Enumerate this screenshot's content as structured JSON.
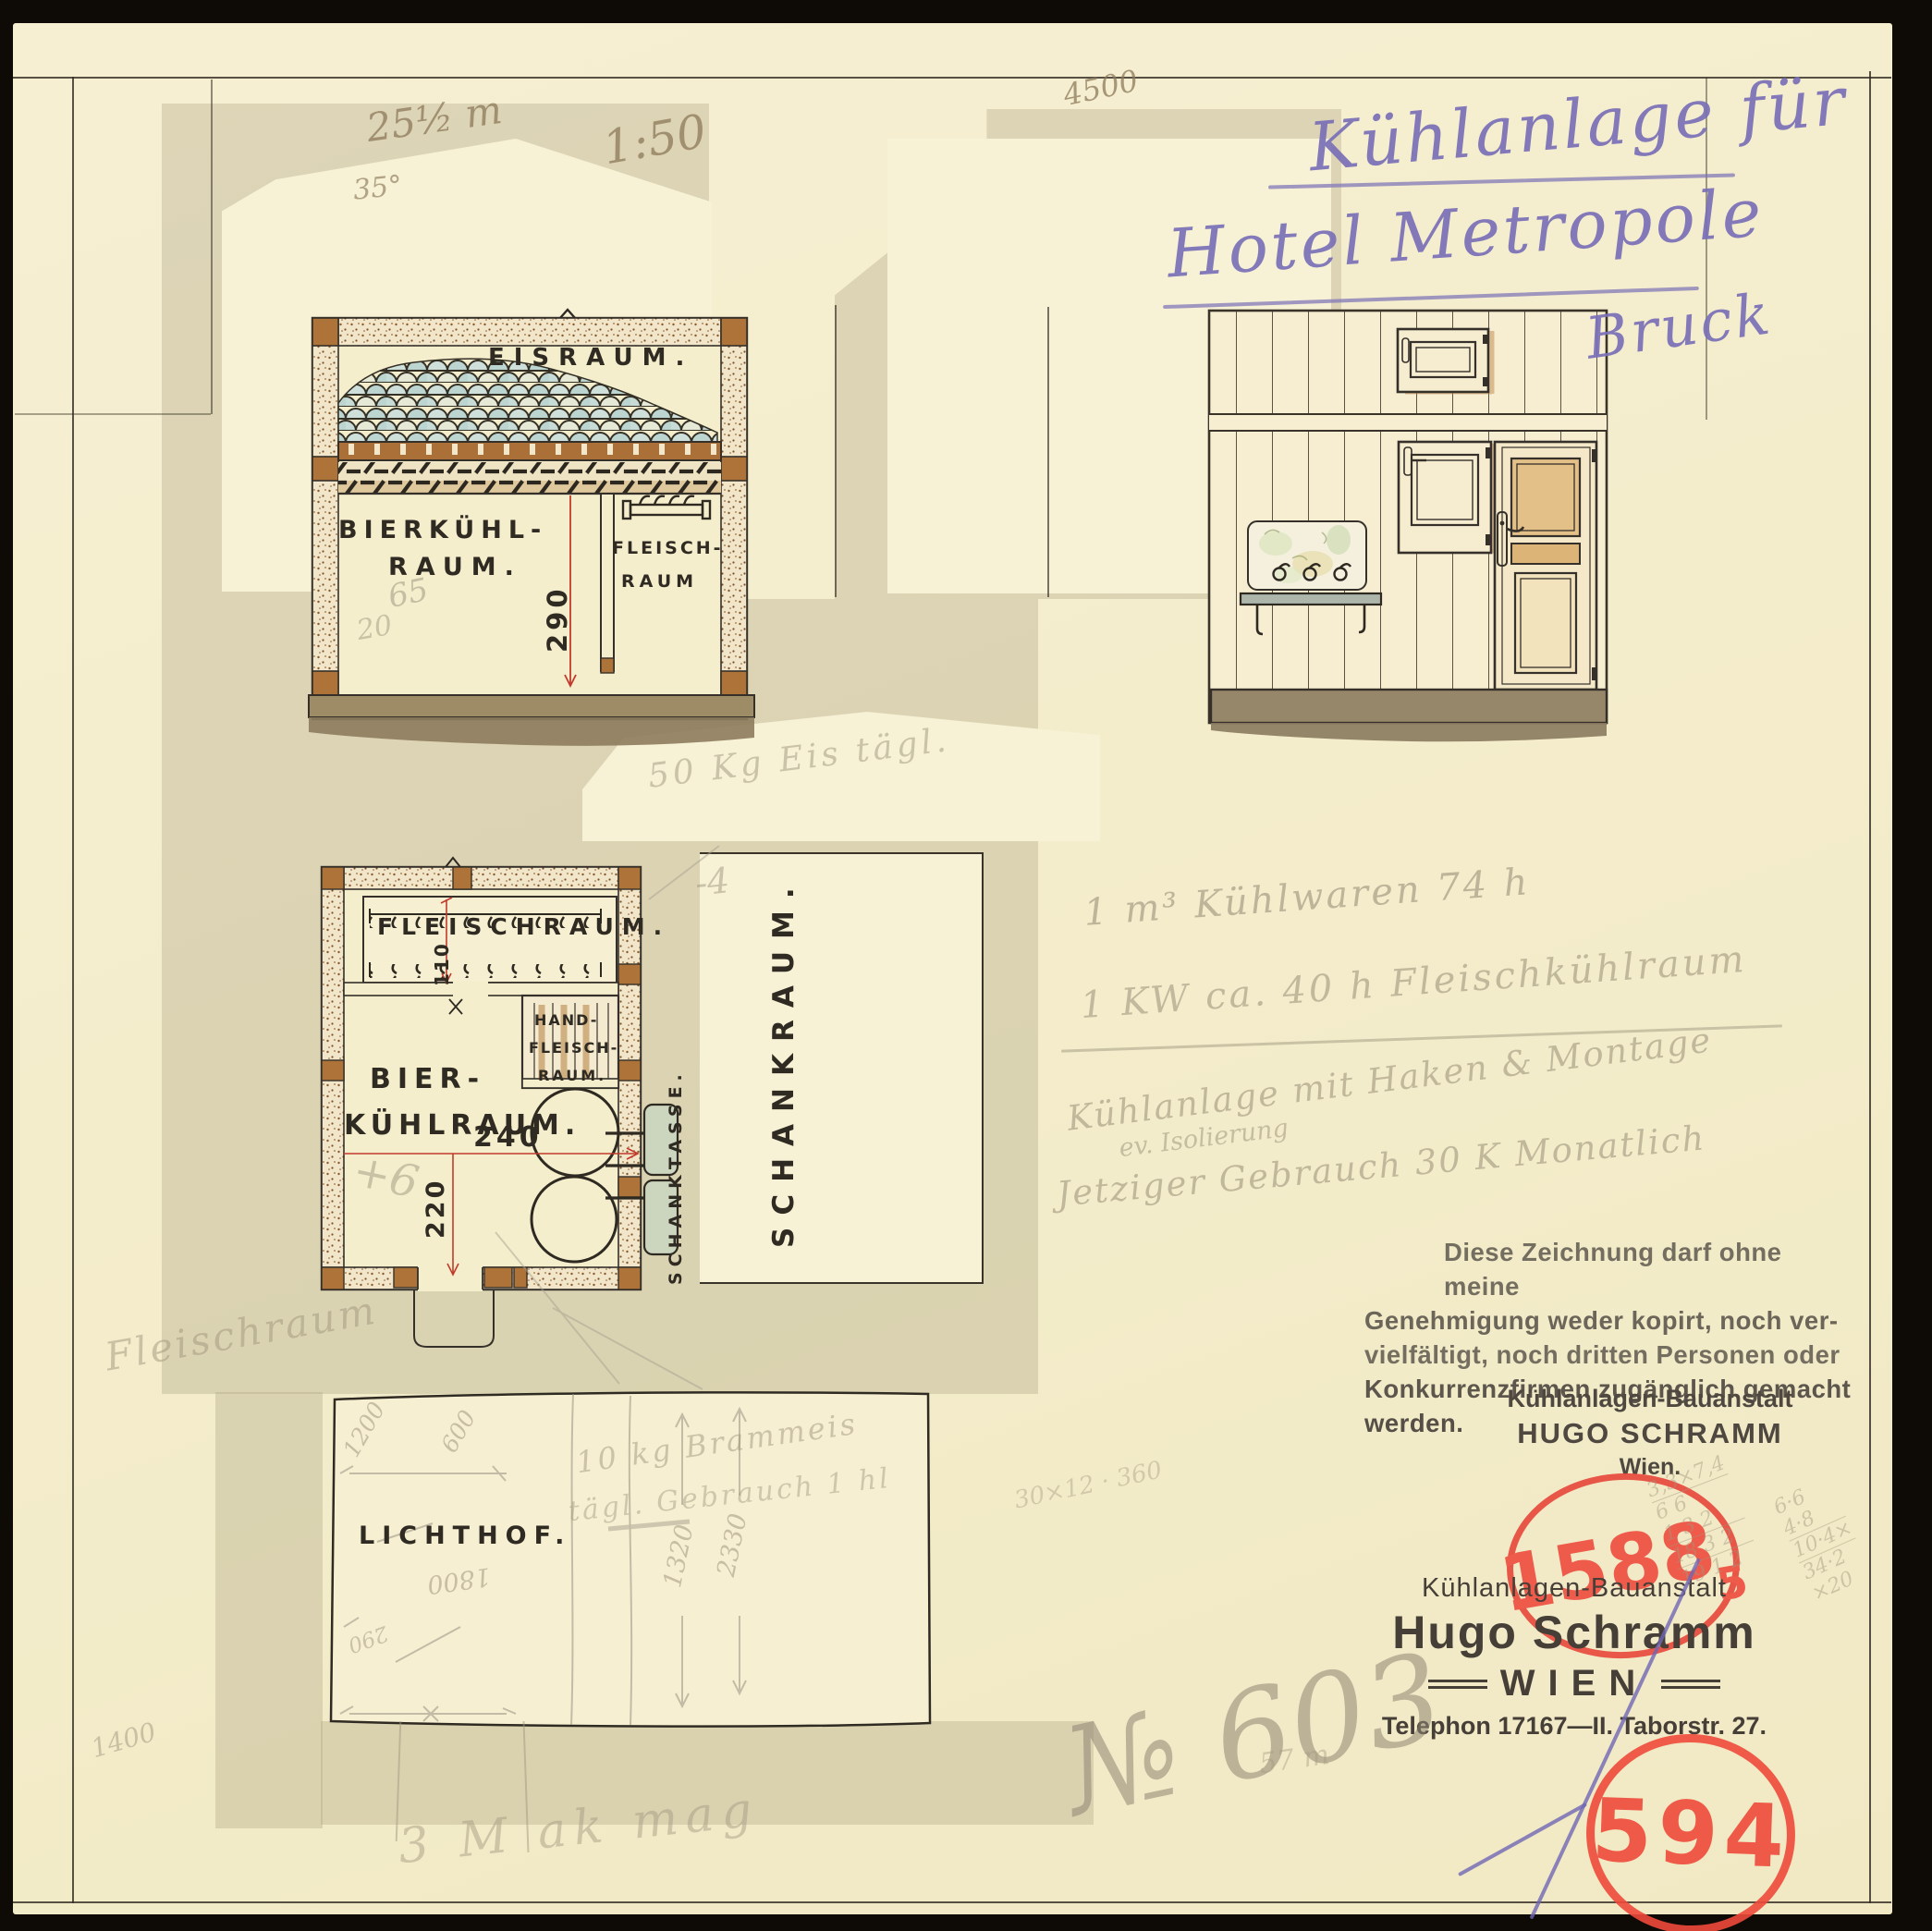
{
  "doc": {
    "title_line1": "Kühlanlage für",
    "title_line2": "Hotel Metropole",
    "title_line3": "Bruck",
    "pencil_4500": "4500",
    "pencil_area": "25½ m",
    "pencil_35": "35°",
    "pencil_scale": "1:50"
  },
  "section": {
    "eisraum": "EISRAUM.",
    "bier_l1": "BIERKÜHL-",
    "bier_l2": "RAUM.",
    "fleisch_l1": "FLEISCH-",
    "fleisch_l2": "RAUM",
    "dim_height": "290",
    "pencil_65": "65",
    "pencil_20": "20"
  },
  "plan": {
    "fleischraum": "FLEISCHRAUM.",
    "dim_110": "110",
    "hand_l1": "HAND-",
    "hand_l2": "FLEISCH-",
    "hand_l3": "RAUM.",
    "bier_l1": "BIER-",
    "bier_l2": "KÜHLRAUM.",
    "dim_240": "240",
    "dim_220": "220",
    "schanktasse": "SCHANKTASSE.",
    "schankraum": "SCHANKRAUM.",
    "pencil_plus6": "+6",
    "pencil_minus4": "-4",
    "pencil_50kg": "50 Kg Eis tägl."
  },
  "lichthof": {
    "label": "LICHTHOF.",
    "n_1200": "1200",
    "n_600": "600",
    "n_1800": "1800",
    "n_1320": "1320",
    "n_2330": "2330",
    "n_290": "290",
    "n_1400": "1400",
    "note1": "10 kg Brammeis",
    "note2": "tägl. Gebrauch 1 hl",
    "scribble": "3 M ak mag"
  },
  "pencil_left": {
    "fleischraum": "Fleischraum"
  },
  "notes_right": {
    "l1": "1 m³ Kühlwaren 74 h",
    "l2": "1 KW ca. 40 h Fleischkühlraum",
    "l3": "Kühlanlage mit Haken & Montage",
    "l4": "ev. Isolierung",
    "l5": "Jetziger Gebrauch 30 K Monatlich"
  },
  "stamps": {
    "disclaimer_l1": "Diese Zeichnung darf ohne meine",
    "disclaimer_l2": "Genehmigung weder kopirt, noch ver-",
    "disclaimer_l3": "vielfältigt, noch dritten Personen oder",
    "disclaimer_l4": "Konkurrenzfirmen zugänglich gemacht",
    "disclaimer_l5": "werden.",
    "firm1_l1": "Kühlanlagen-Bauanstalt",
    "firm1_l2": "HUGO SCHRAMM",
    "firm1_l3": "Wien.",
    "reg_number": "1588",
    "reg_sub": "5",
    "firm2_l1": "Kühlanlagen-Bauanstalt",
    "firm2_l2": "Hugo Schramm",
    "firm2_l3": "WIEN",
    "firm2_l4": "Telephon 17167—II. Taborstr. 27.",
    "file_number": "594",
    "pencil_no": "№ 603",
    "pencil_57": "57 m"
  },
  "calcs": {
    "left": "30×12 · 360",
    "a1": "3,3×7,4",
    "a2": "6 6",
    "a3": "1 3 2",
    "a4": "18 3 2",
    "a5": "19 1 2",
    "b1": "6·6",
    "b2": "4·8",
    "b3": "10·4×",
    "b4": "34·2",
    "b5": "×20"
  },
  "colors": {
    "paper": "#f4edcd",
    "wash": "#b8ae8c",
    "ink": "#35302a",
    "stamp_red": "#e8473c",
    "dim_red": "#c23a2c",
    "violet": "#6f66b4",
    "pencil": "#a1977f",
    "blue_ink": "#7a70b8"
  }
}
